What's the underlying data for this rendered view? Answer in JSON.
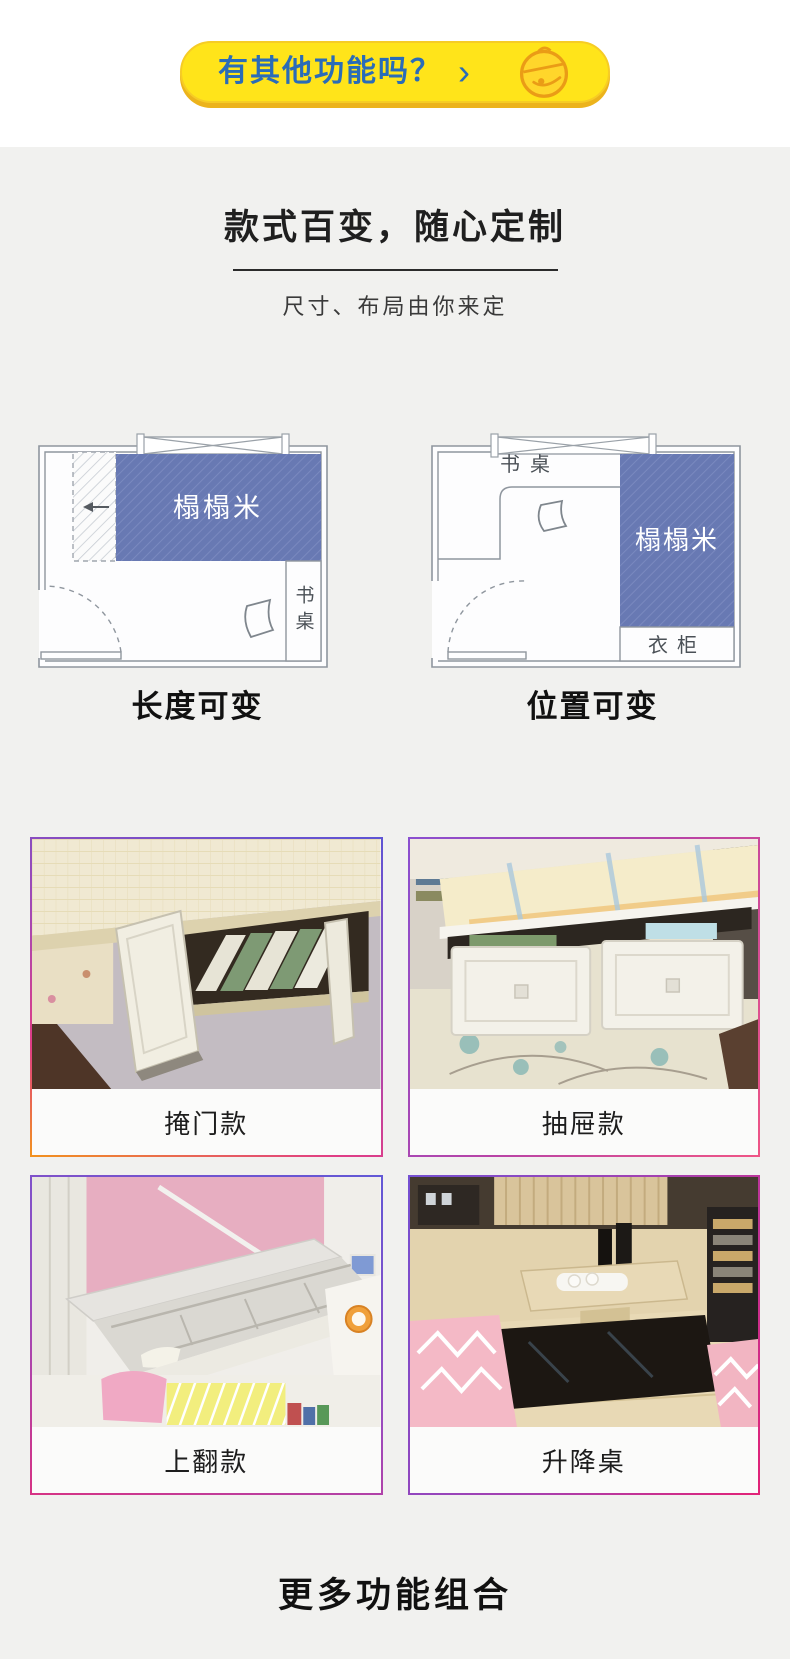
{
  "cta": {
    "label": "有其他功能吗？",
    "chevron": "›",
    "icon": "bell"
  },
  "intro": {
    "title": "款式百变，随心定制",
    "subtitle": "尺寸、布局由你来定"
  },
  "plans": {
    "left": {
      "tatami": "榻榻米",
      "desk": "书桌",
      "caption": "长度可变"
    },
    "right": {
      "desk": "书桌",
      "tatami": "榻榻米",
      "wardrobe": "衣柜",
      "caption": "位置可变"
    }
  },
  "cards": [
    {
      "caption": "掩门款"
    },
    {
      "caption": "抽屉款"
    },
    {
      "caption": "上翻款"
    },
    {
      "caption": "升降桌"
    }
  ],
  "footer": {
    "title": "更多功能组合"
  },
  "colors": {
    "button_yellow": "#FFE41A",
    "button_text_blue": "#2A6CB8",
    "tatami_blue": "#6879B3",
    "page_bg": "#F1F1EF"
  }
}
